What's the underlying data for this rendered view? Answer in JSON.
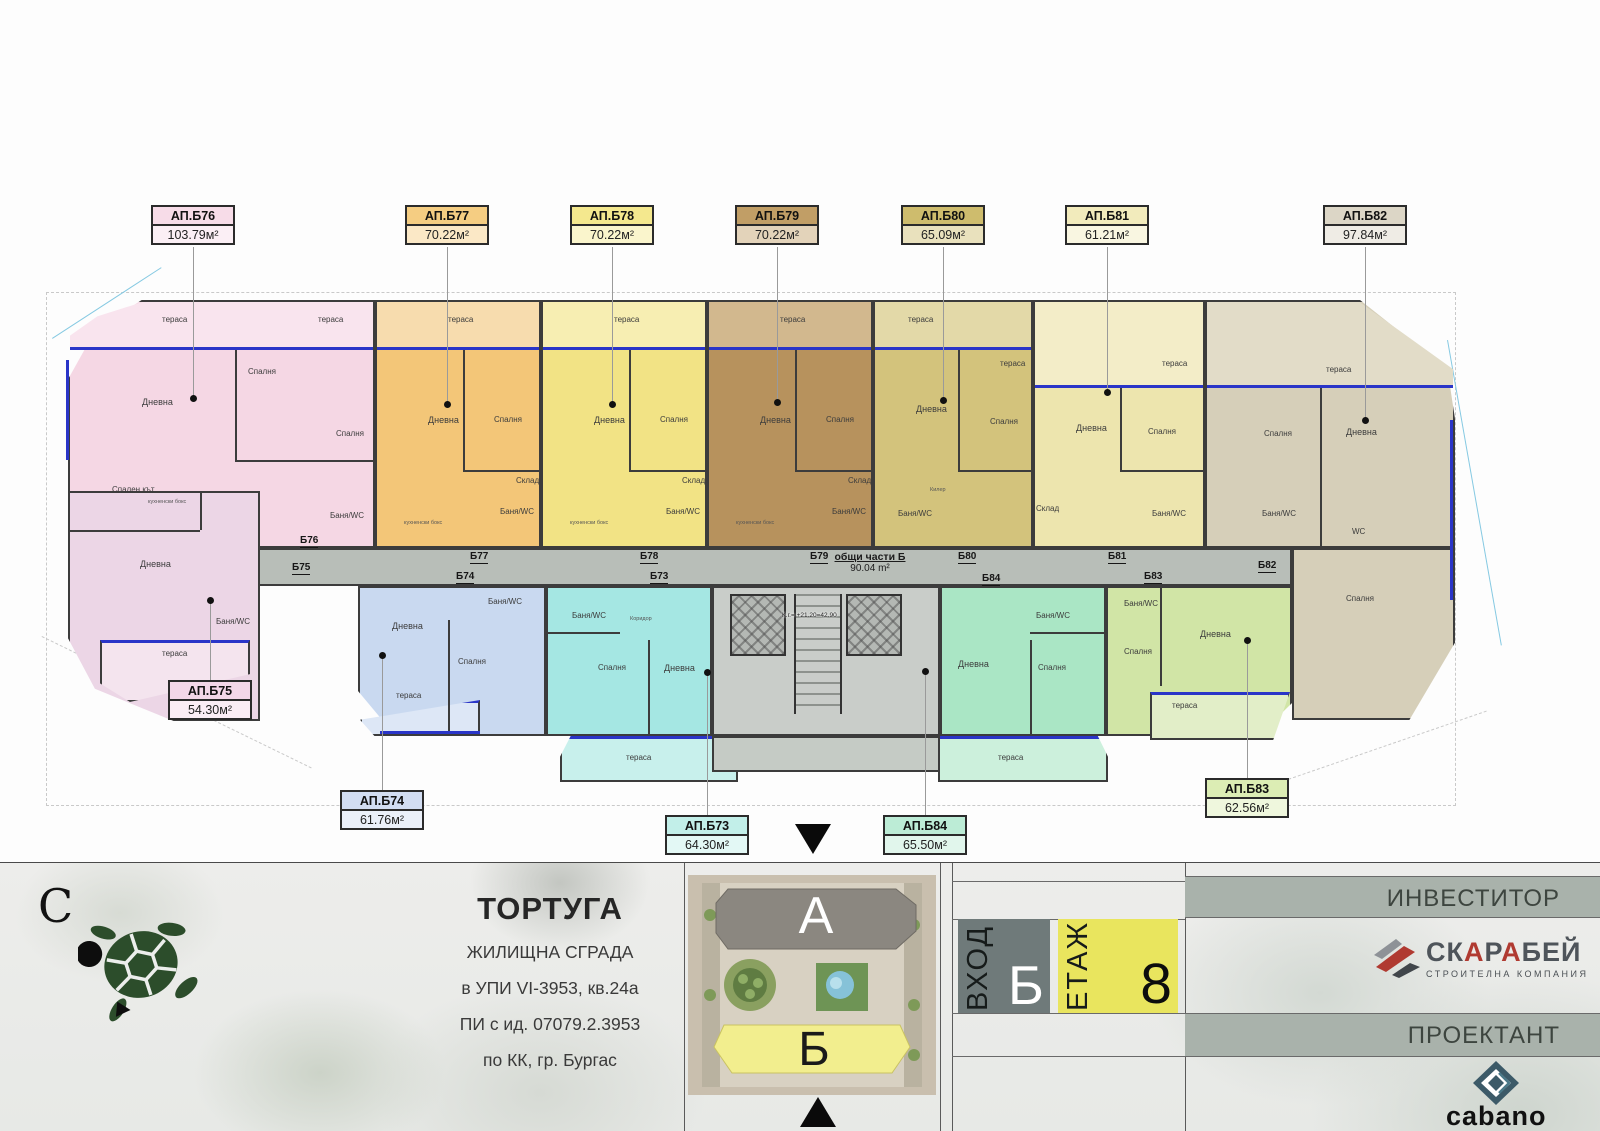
{
  "plan": {
    "common": {
      "name": "общи части Б",
      "area": "90.04 m²"
    },
    "core_note": "К.г.= +21.20=42.90",
    "units": [
      {
        "id": "АП.Б76",
        "area": "103.79м²",
        "tag": "Б76",
        "color": "#f5d7e4",
        "rooms": [
          "тераса",
          "тераса",
          "Спалня",
          "Дневна",
          "Спалня",
          "кухненски бокс",
          "Баня/WC"
        ]
      },
      {
        "id": "АП.Б77",
        "area": "70.22м²",
        "tag": "Б77",
        "color": "#f3c678",
        "rooms": [
          "тераса",
          "Дневна",
          "Спалня",
          "Склад",
          "кухненски бокс",
          "Баня/WC"
        ]
      },
      {
        "id": "АП.Б78",
        "area": "70.22м²",
        "tag": "Б78",
        "color": "#f2e385",
        "rooms": [
          "тераса",
          "Дневна",
          "Спалня",
          "Склад",
          "кухненски бокс",
          "Баня/WC"
        ]
      },
      {
        "id": "АП.Б79",
        "area": "70.22м²",
        "tag": "Б79",
        "color": "#b7925d",
        "rooms": [
          "тераса",
          "Дневна",
          "Спалня",
          "Склад",
          "кухненски бокс",
          "Баня/WC"
        ]
      },
      {
        "id": "АП.Б80",
        "area": "65.09м²",
        "tag": "Б80",
        "color": "#d3c37c",
        "rooms": [
          "тераса",
          "Дневна",
          "Спалня",
          "Килер",
          "Баня/WC"
        ]
      },
      {
        "id": "АП.Б81",
        "area": "61.21м²",
        "tag": "Б81",
        "color": "#ede5ae",
        "rooms": [
          "тераса",
          "тераса",
          "Дневна",
          "Спалня",
          "Склад",
          "Баня/WC"
        ]
      },
      {
        "id": "АП.Б82",
        "area": "97.84м²",
        "tag": "Б82",
        "color": "#d6cfb9",
        "rooms": [
          "тераса",
          "Спалня",
          "Дневна",
          "WC",
          "Баня/WC",
          "Спалня"
        ]
      },
      {
        "id": "АП.Б75",
        "area": "54.30м²",
        "tag": "Б75",
        "color": "#ecd6e6",
        "rooms": [
          "Спален кът",
          "Дневна",
          "Баня/WC",
          "тераса"
        ]
      },
      {
        "id": "АП.Б74",
        "area": "61.76м²",
        "tag": "Б74",
        "color": "#c9d9f0",
        "rooms": [
          "Баня/WC",
          "Дневна",
          "Спалня",
          "тераса"
        ]
      },
      {
        "id": "АП.Б73",
        "area": "64.30м²",
        "tag": "Б73",
        "color": "#a5e7e3",
        "rooms": [
          "Баня/WC",
          "Коридор",
          "Спалня",
          "Дневна",
          "тераса"
        ]
      },
      {
        "id": "АП.Б84",
        "area": "65.50м²",
        "tag": "Б84",
        "color": "#aae6c5",
        "rooms": [
          "Баня/WC",
          "Дневна",
          "Спалня",
          "тераса"
        ]
      },
      {
        "id": "АП.Б83",
        "area": "62.56м²",
        "tag": "Б83",
        "color": "#d1e5a6",
        "rooms": [
          "Баня/WC",
          "Спалня",
          "Дневна",
          "тераса"
        ]
      }
    ]
  },
  "footer": {
    "north_letter": "С",
    "project": {
      "title": "ТОРТУГА",
      "line1": "ЖИЛИЩНА СГРАДА",
      "line2": "в УПИ VI-3953, кв.24а",
      "line3": "ПИ с ид. 07079.2.3953",
      "line4": "по КК, гр. Бургас"
    },
    "siteplan": {
      "building_a": "А",
      "building_b": "Б"
    },
    "entrance": {
      "label": "ВХОД",
      "value": "Б"
    },
    "floor": {
      "label": "ЕТАЖ",
      "value": "8"
    },
    "investor": {
      "label": "ИНВЕСТИТОР",
      "brand": "СКАРАБЕЙ",
      "brand_parts": [
        "СК",
        "А",
        "Р",
        "А",
        "БЕЙ"
      ],
      "brand_sub": "СТРОИТЕЛНА КОМПАНИЯ"
    },
    "designer": {
      "label": "ПРОЕКТАНТ",
      "brand": "cabano"
    },
    "colors": {
      "entrance_box": "#6f7a7a",
      "floor_box": "#e9e55e",
      "band": "#a9b2ab",
      "scarab_red": "#b03a31",
      "cabano_teal": "#3c5a68"
    }
  }
}
